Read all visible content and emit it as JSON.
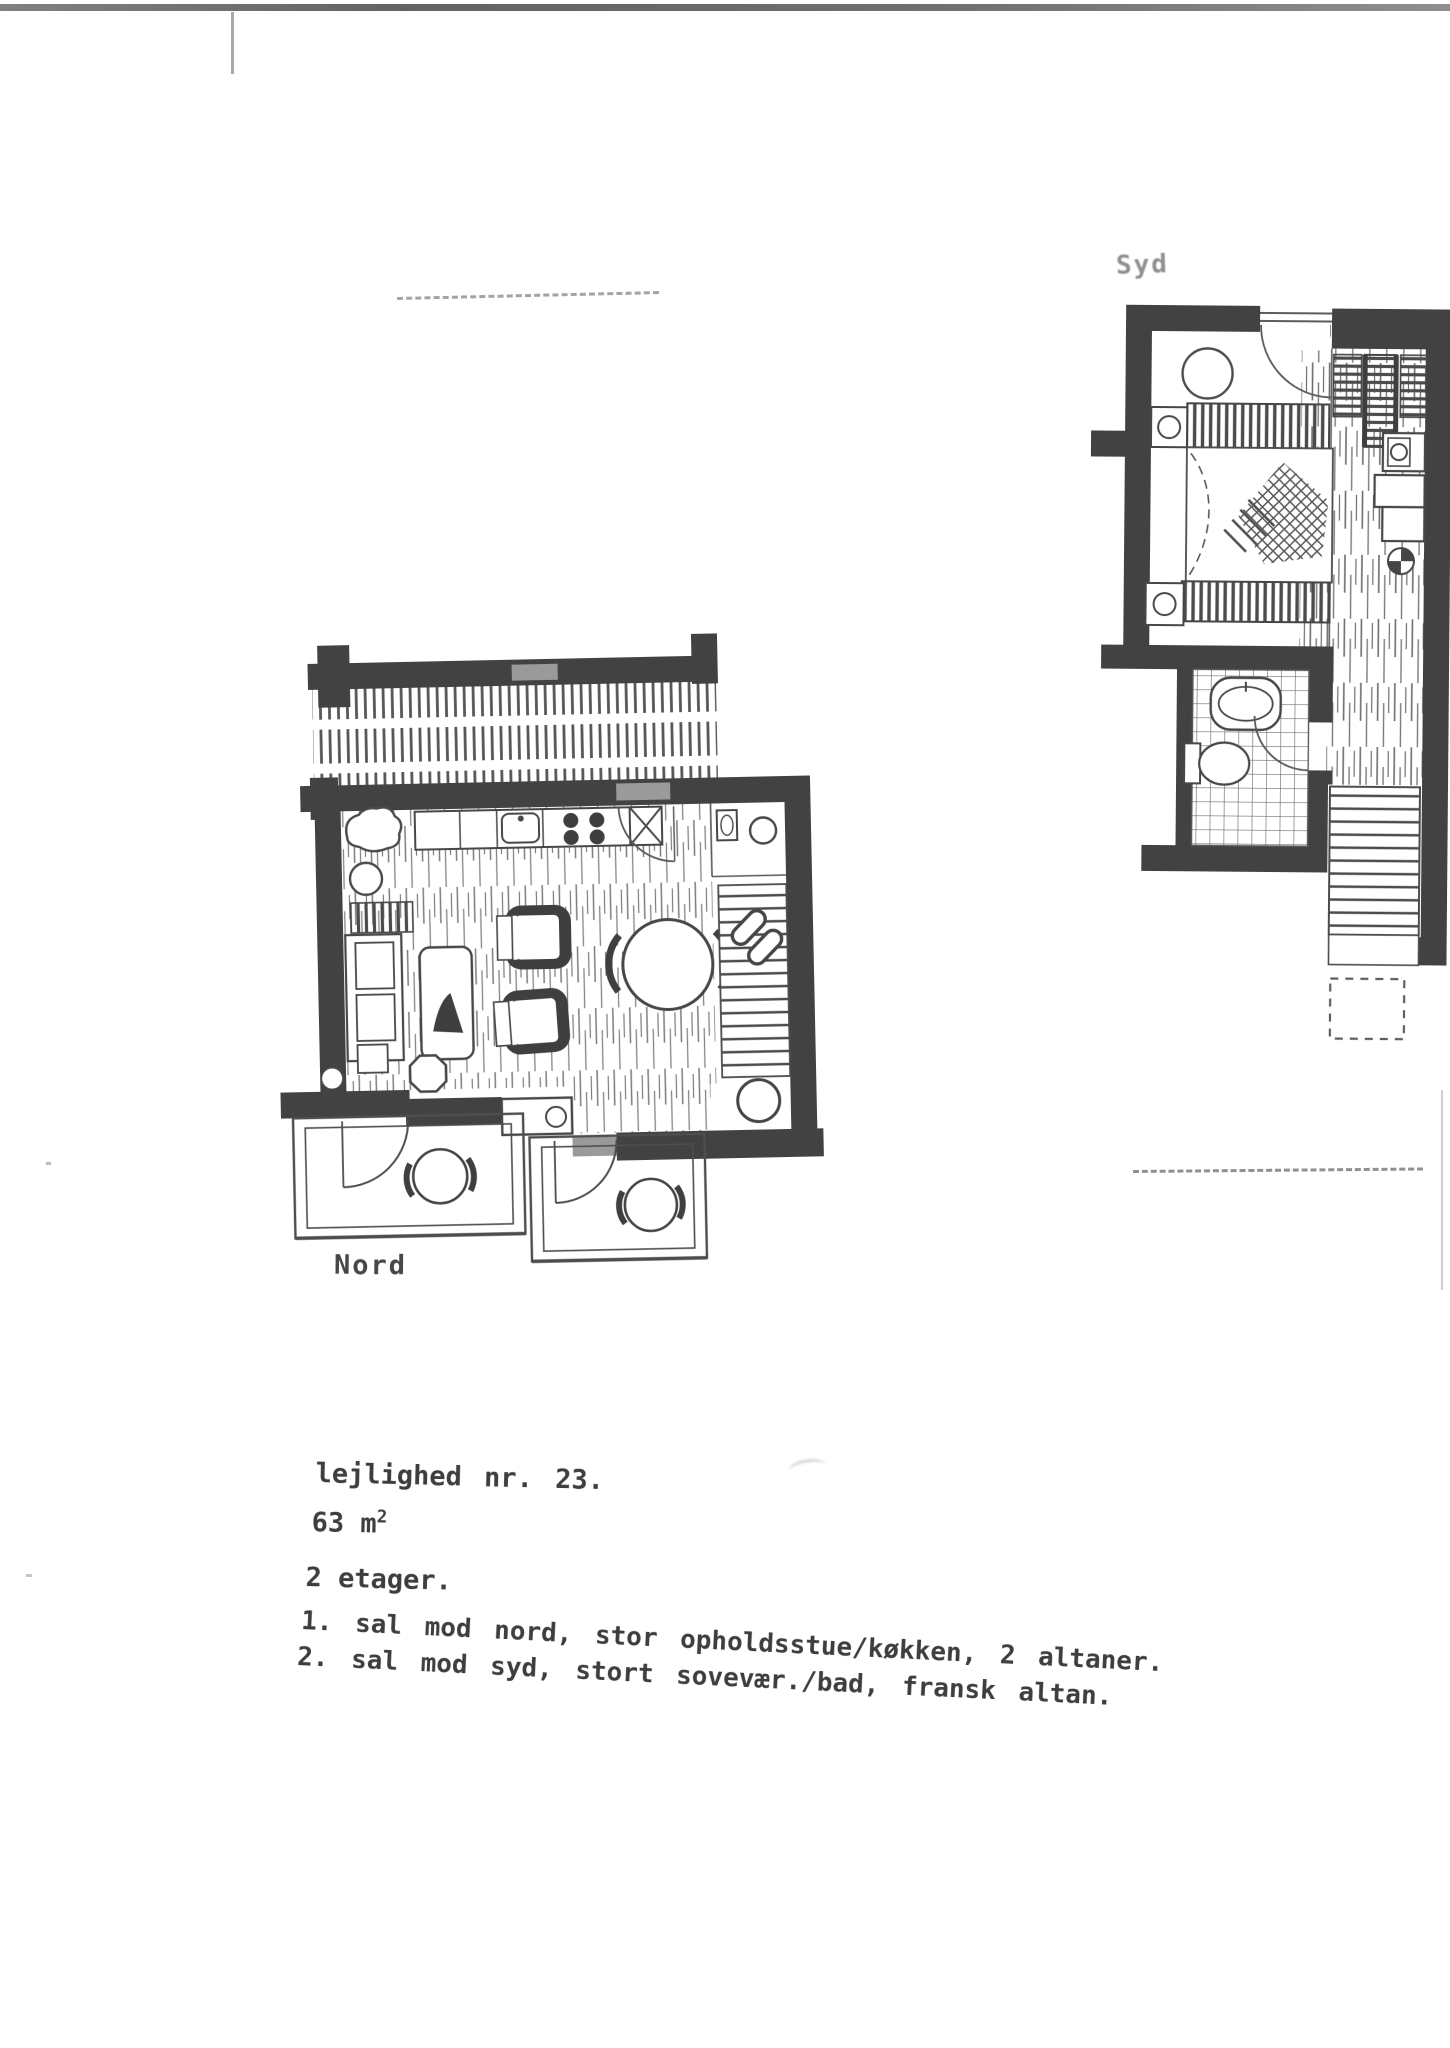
{
  "page": {
    "background": "#ffffff",
    "ink_color": "#3e3e3e",
    "wall_color": "#424242",
    "faint_ink_color": "#8f8f8f",
    "type": "scanned floor plan sheet"
  },
  "plans": {
    "syd": {
      "label": "Syd",
      "features": [
        "bedroom",
        "bed",
        "nightstands",
        "wardrobe",
        "wood-floor-corridor",
        "bathroom",
        "sink",
        "toilet",
        "staircase",
        "french-balcony-dashed"
      ]
    },
    "nord": {
      "label": "Nord",
      "features": [
        "living-room",
        "kitchen-counter",
        "sink",
        "stove",
        "sofa",
        "coffee-table-with-plant",
        "armchairs",
        "dining-table",
        "wc",
        "staircase",
        "balcony-left",
        "balcony-right",
        "balcony-tables"
      ]
    }
  },
  "caption": {
    "line1": "lejlighed nr. 23.",
    "area_value": "63 m",
    "area_sup": "2",
    "line3": "2 etager.",
    "line4": "1. sal mod nord, stor opholdsstue/køkken, 2 altaner.",
    "line5": "2. sal mod syd, stort sovevær./bad, fransk altan."
  }
}
